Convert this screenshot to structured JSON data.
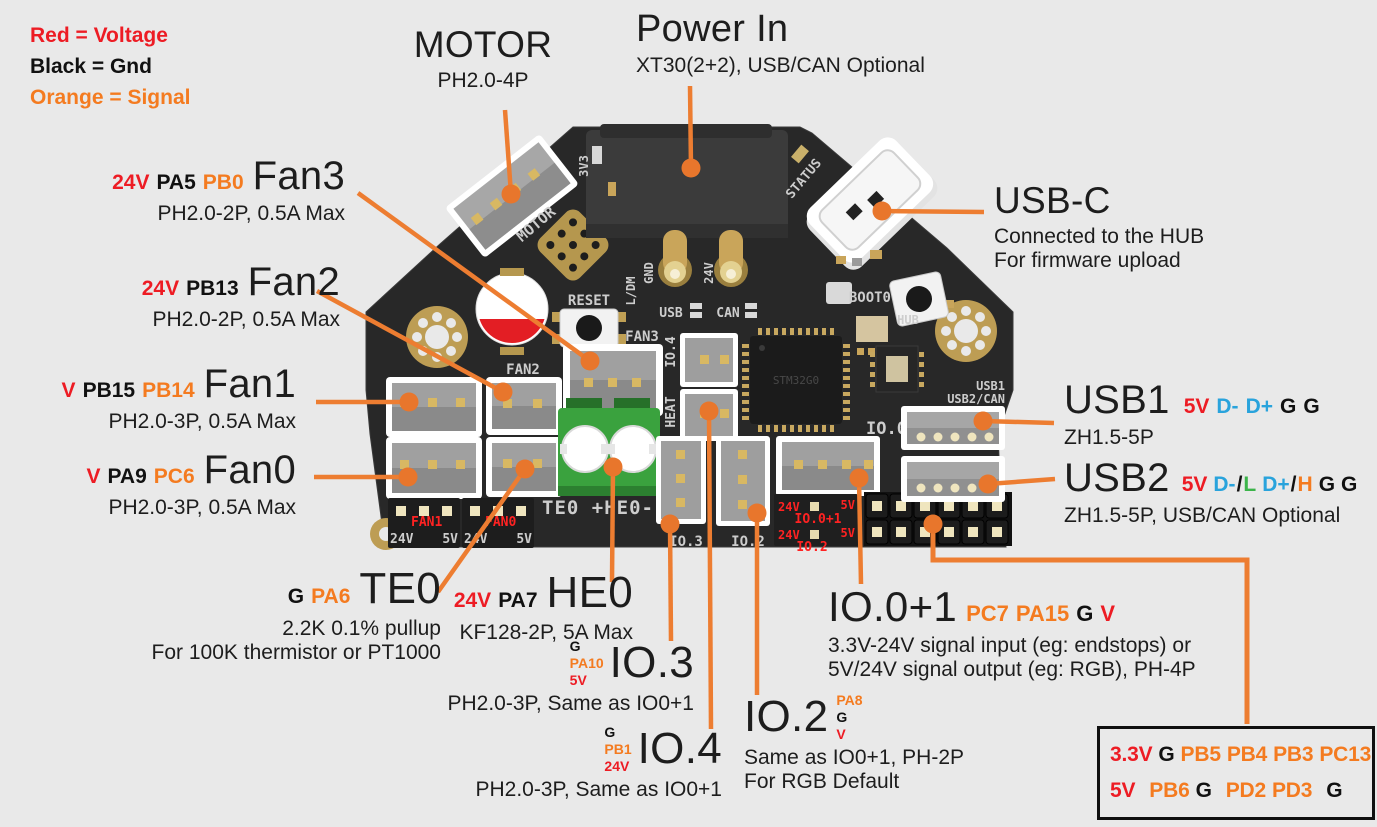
{
  "page": {
    "background": "#e9e9e9"
  },
  "palette": {
    "voltage": "#ed1c24",
    "gnd": "#111111",
    "signal": "#f47b20",
    "usb_data": "#29a3dc",
    "can_low": "#3cb44a",
    "can_high": "#f47b20",
    "annotation_line": "#ed7d31",
    "board": "#282828",
    "gold": "#c9a55a"
  },
  "legend": {
    "items": [
      {
        "text": "Red = Voltage",
        "role": "voltage"
      },
      {
        "text": "Black = Gnd",
        "role": "gnd"
      },
      {
        "text": "Orange = Signal",
        "role": "signal"
      }
    ]
  },
  "annotations": {
    "motor": {
      "title": "MOTOR",
      "sub": "PH2.0-4P"
    },
    "power": {
      "title": "Power In",
      "sub": "XT30(2+2), USB/CAN Optional"
    },
    "usbc": {
      "title": "USB-C",
      "sub1": "Connected to the HUB",
      "sub2": "For firmware upload"
    },
    "fan3": {
      "title": "Fan3",
      "sub": "PH2.0-2P, 0.5A Max",
      "pins": [
        {
          "t": "24V",
          "c": "voltage"
        },
        {
          "t": "PA5",
          "c": "gnd"
        },
        {
          "t": "PB0",
          "c": "signal"
        }
      ]
    },
    "fan2": {
      "title": "Fan2",
      "sub": "PH2.0-2P, 0.5A Max",
      "pins": [
        {
          "t": "24V",
          "c": "voltage"
        },
        {
          "t": "PB13",
          "c": "gnd"
        }
      ]
    },
    "fan1": {
      "title": "Fan1",
      "sub": "PH2.0-3P, 0.5A Max",
      "pins": [
        {
          "t": "V",
          "c": "voltage"
        },
        {
          "t": "PB15",
          "c": "gnd"
        },
        {
          "t": "PB14",
          "c": "signal"
        }
      ]
    },
    "fan0": {
      "title": "Fan0",
      "sub": "PH2.0-3P, 0.5A Max",
      "pins": [
        {
          "t": "V",
          "c": "voltage"
        },
        {
          "t": "PA9",
          "c": "gnd"
        },
        {
          "t": "PC6",
          "c": "signal"
        }
      ]
    },
    "te0": {
      "title": "TE0",
      "sub1": "2.2K 0.1% pullup",
      "sub2": "For 100K thermistor or PT1000",
      "pins": [
        {
          "t": "G",
          "c": "gnd"
        },
        {
          "t": "PA6",
          "c": "signal"
        }
      ]
    },
    "he0": {
      "title": "HE0",
      "sub": "KF128-2P, 5A Max",
      "pins": [
        {
          "t": "24V",
          "c": "voltage"
        },
        {
          "t": "PA7",
          "c": "gnd"
        }
      ]
    },
    "io3": {
      "title": "IO.3",
      "sub": "PH2.0-3P, Same as IO0+1",
      "stack": [
        {
          "t": "G",
          "c": "gnd"
        },
        {
          "t": "PA10",
          "c": "signal"
        },
        {
          "t": "5V",
          "c": "voltage"
        }
      ]
    },
    "io4": {
      "title": "IO.4",
      "sub": "PH2.0-3P, Same as IO0+1",
      "stack": [
        {
          "t": "G",
          "c": "gnd"
        },
        {
          "t": "PB1",
          "c": "signal"
        },
        {
          "t": "24V",
          "c": "voltage"
        }
      ]
    },
    "io2": {
      "title": "IO.2",
      "sub1": "Same as IO0+1, PH-2P",
      "sub2": "For RGB Default",
      "stack": [
        {
          "t": "PA8",
          "c": "signal"
        },
        {
          "t": "G",
          "c": "gnd"
        },
        {
          "t": "V",
          "c": "voltage"
        }
      ]
    },
    "io01": {
      "title": "IO.0+1",
      "sub1": "3.3V-24V signal input (eg: endstops) or",
      "sub2": "5V/24V signal output (eg: RGB), PH-4P",
      "pins": [
        {
          "t": "PC7",
          "c": "signal"
        },
        {
          "t": "PA15",
          "c": "signal"
        },
        {
          "t": "G",
          "c": "gnd"
        },
        {
          "t": "V",
          "c": "voltage"
        }
      ]
    },
    "usb1": {
      "title": "USB1",
      "sub": "ZH1.5-5P",
      "pins": [
        {
          "t": "5V",
          "c": "voltage"
        },
        {
          "t": "D-",
          "c": "usb_data"
        },
        {
          "t": "D+",
          "c": "usb_data"
        },
        {
          "t": "G",
          "c": "gnd"
        },
        {
          "t": "G",
          "c": "gnd"
        }
      ]
    },
    "usb2": {
      "title": "USB2",
      "sub": "ZH1.5-5P, USB/CAN Optional",
      "pins": [
        {
          "t": "5V",
          "c": "voltage"
        },
        {
          "t": "D-",
          "c": "usb_data"
        },
        {
          "t": "/",
          "c": "gnd"
        },
        {
          "t": "L",
          "c": "can_low"
        },
        {
          "t": "D+",
          "c": "usb_data"
        },
        {
          "t": "/",
          "c": "gnd"
        },
        {
          "t": "H",
          "c": "can_high"
        },
        {
          "t": "G",
          "c": "gnd"
        },
        {
          "t": "G",
          "c": "gnd"
        }
      ]
    }
  },
  "pinbox": {
    "rows": [
      [
        {
          "t": "3.3V",
          "c": "voltage"
        },
        {
          "t": "G",
          "c": "gnd"
        },
        {
          "t": "PB5",
          "c": "signal"
        },
        {
          "t": "PB4",
          "c": "signal"
        },
        {
          "t": "PB3",
          "c": "signal"
        },
        {
          "t": "PC13",
          "c": "signal"
        }
      ],
      [
        {
          "t": "5V",
          "c": "voltage"
        },
        {
          "t": "PB6",
          "c": "signal"
        },
        {
          "t": "G",
          "c": "gnd"
        },
        {
          "t": "PD2",
          "c": "signal"
        },
        {
          "t": "PD3",
          "c": "signal"
        },
        {
          "t": "G",
          "c": "gnd"
        }
      ]
    ]
  },
  "board": {
    "silk": {
      "v3": "3V3",
      "motor": "MOTOR",
      "status": "STATUS",
      "ldm": "L/DM",
      "gnd": "GND",
      "v24": "24V",
      "usb": "USB",
      "can": "CAN",
      "reset": "RESET",
      "boot0": "BOOT0",
      "hub": "HUB",
      "fan3": "FAN3",
      "fan2": "FAN2",
      "io4": "IO.4",
      "heat": "HEAT",
      "te0he0": "TE0 +HE0-",
      "rail24": "24V",
      "rail5": "5V",
      "fan1": "FAN1",
      "fan0": "FAN0",
      "io3": "IO.3",
      "io2": "IO.2",
      "io01red": "IO.0+1",
      "io2red": "IO.2",
      "io01": "IO.01",
      "usb1": "USB1",
      "usb2can": "USB2/CAN",
      "chip": "STM32G0"
    }
  }
}
